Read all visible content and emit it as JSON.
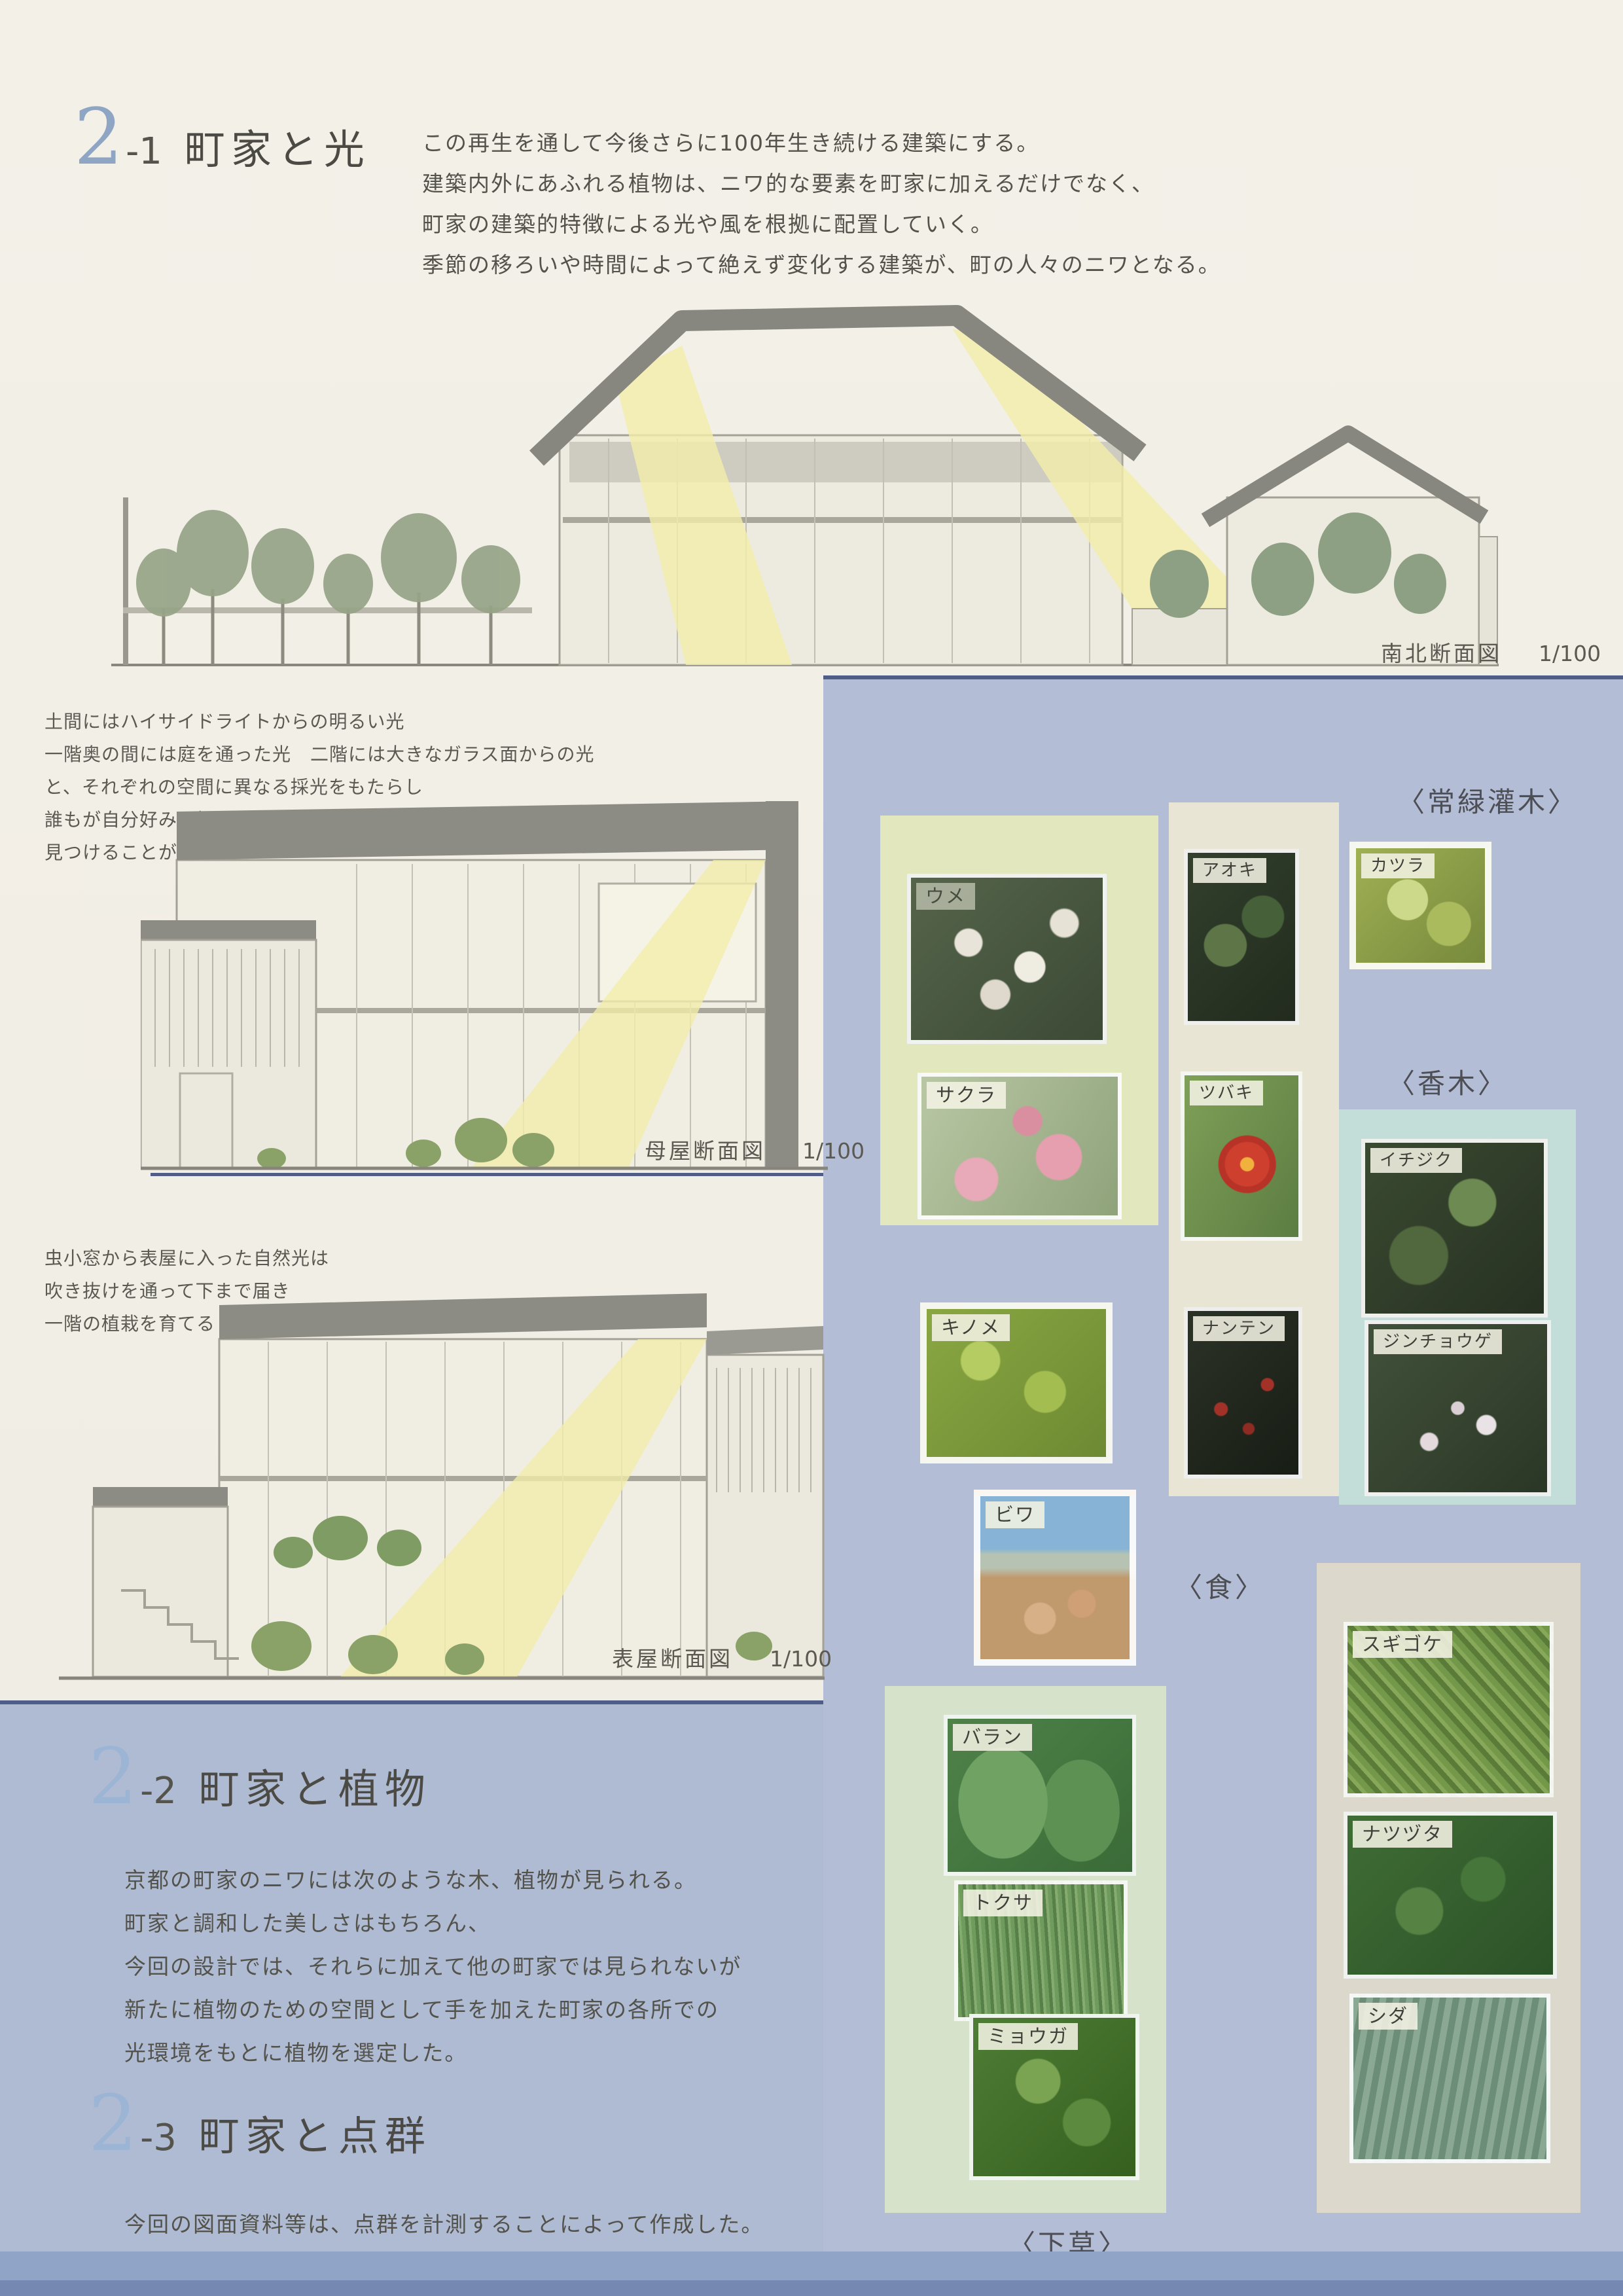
{
  "colors": {
    "paper": "#f1eee5",
    "panel_lavender": "#b3bed6",
    "accent_navy": "#4f5d88",
    "light_yellow": "#f2eda9",
    "bottom_strip": "#8fa4c7",
    "section_number_blue": "#8ea5c3"
  },
  "section21": {
    "num_major": "2",
    "num_minor": "-1",
    "title": "町家と光",
    "lines": [
      "この再生を通して今後さらに100年生き続ける建築にする。",
      "建築内外にあふれる植物は、ニワ的な要素を町家に加えるだけでなく、",
      "町家の建築的特徴による光や風を根拠に配置していく。",
      "季節の移ろいや時間によって絶えず変化する建築が、町の人々のニワとなる。"
    ]
  },
  "note1": {
    "lines": [
      "土間にはハイサイドライトからの明るい光",
      "一階奥の間には庭を通った光　二階には大きなガラス面からの光",
      "と、それぞれの空間に異なる採光をもたらし",
      "誰もが自分好みの場所を",
      "見つけることができる"
    ]
  },
  "note2": {
    "lines": [
      "虫小窓から表屋に入った自然光は",
      "吹き抜けを通って下まで届き",
      "一階の植栽を育てる"
    ]
  },
  "captions": {
    "c1": {
      "name": "南北断面図",
      "scale": "1/100"
    },
    "c2": {
      "name": "母屋断面図",
      "scale": "1/100"
    },
    "c3": {
      "name": "表屋断面図",
      "scale": "1/100"
    }
  },
  "section22": {
    "num_major": "2",
    "num_minor": "-2",
    "title": "町家と植物",
    "lines": [
      "京都の町家のニワには次のような木、植物が見られる。",
      "町家と調和した美しさはもちろん、",
      "今回の設計では、それらに加えて他の町家では見られないが",
      "新たに植物のための空間として手を加えた町家の各所での",
      "光環境をもとに植物を選定した。"
    ]
  },
  "section23": {
    "num_major": "2",
    "num_minor": "-3",
    "title": "町家と点群",
    "lines": [
      "今回の図面資料等は、点群を計測することによって作成した。"
    ]
  },
  "plant_headers": {
    "evergreen": "〈常緑灌木〉",
    "fragrant": "〈香木〉",
    "food": "〈食〉",
    "undergrowth": "〈下草〉"
  },
  "plants": {
    "ume": "ウメ",
    "sakura": "サクラ",
    "aoki": "アオキ",
    "katsura": "カツラ",
    "tsubaki": "ツバキ",
    "nanten": "ナンテン",
    "ichijiku": "イチジク",
    "jinchoge": "ジンチョウゲ",
    "kinome": "キノメ",
    "biwa": "ビワ",
    "baran": "バラン",
    "tokusa": "トクサ",
    "myoga": "ミョウガ",
    "sugigoke": "スギゴケ",
    "natsuzuta": "ナツヅタ",
    "shida": "シダ"
  }
}
